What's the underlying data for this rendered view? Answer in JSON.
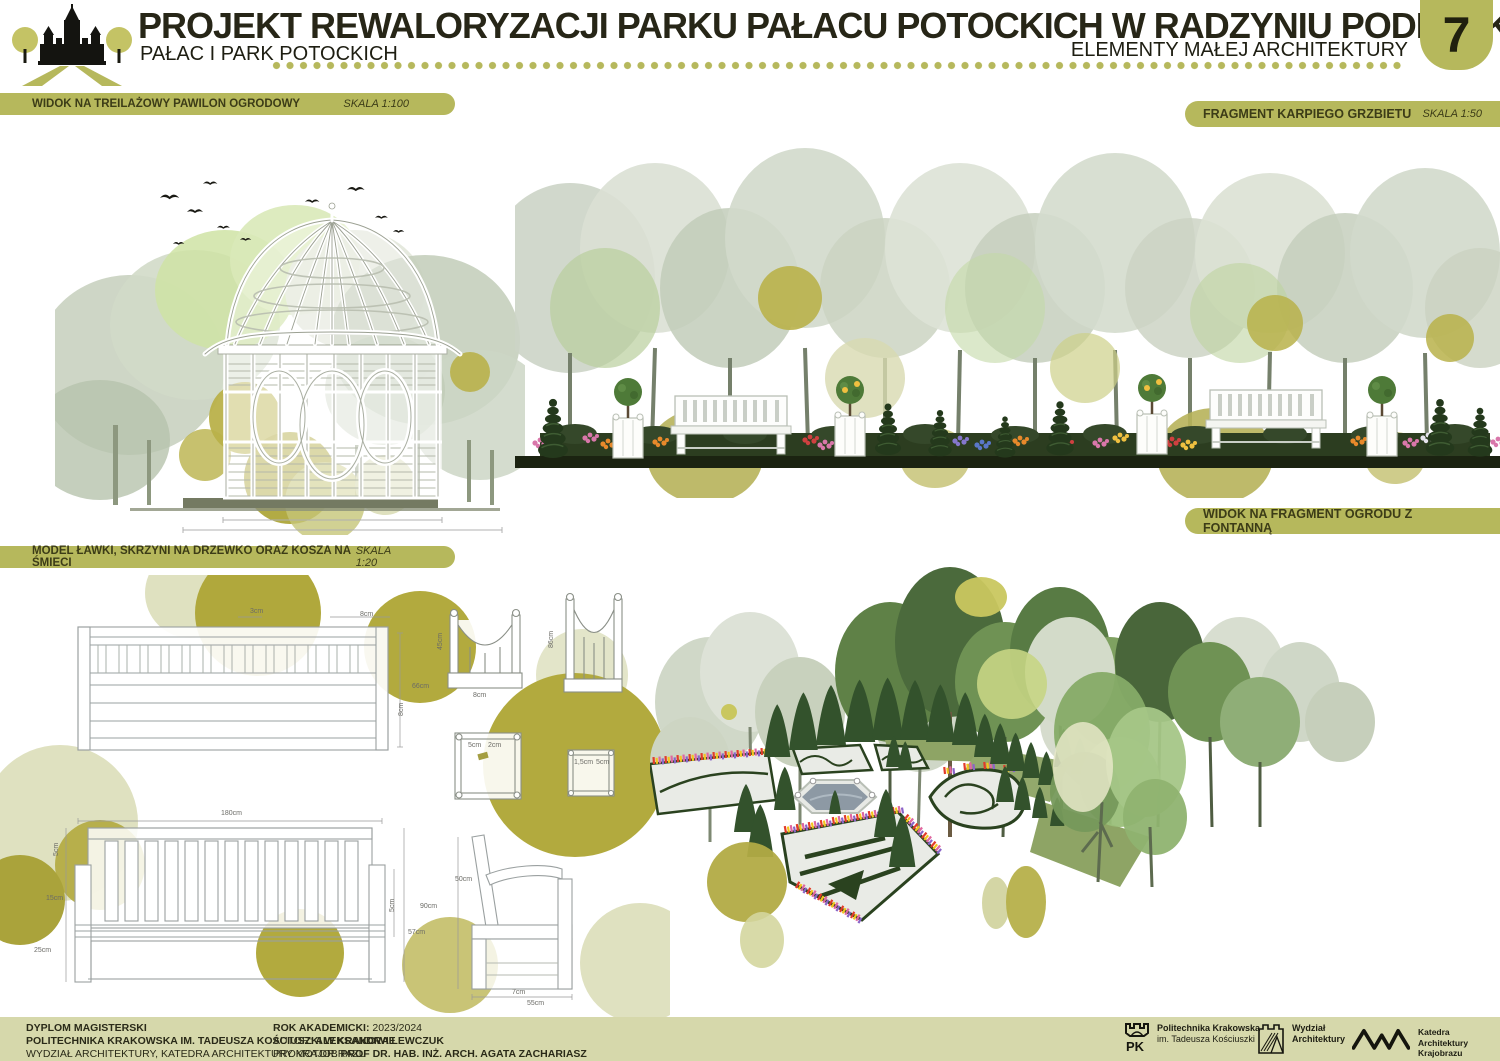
{
  "header": {
    "title": "PROJEKT REWALORYZACJI PARKU PAŁACU POTOCKICH W RADZYNIU PODLASKIM",
    "project_name": "PAŁAC I PARK POTOCKICH",
    "sheet_subject": "ELEMENTY MAŁEJ ARCHITEKTURY",
    "sheet_number": "7"
  },
  "section_labels": {
    "pavilion": {
      "title": "WIDOK NA TREILAŻOWY PAWILON OGRODOWY",
      "scale": "SKALA 1:100"
    },
    "carp_back": {
      "title": "FRAGMENT KARPIEGO GRZBIETU",
      "scale": "SKALA 1:50"
    },
    "fountain_view": {
      "title": "WIDOK NA FRAGMENT OGRODU Z FONTANNĄ"
    },
    "furniture": {
      "title": "MODEL ŁAWKI, SKRZYNI NA DRZEWKO ORAZ KOSZA NA ŚMIECI",
      "scale": "SKALA 1:20"
    }
  },
  "dimensions": {
    "bench_top": {
      "slat_gap": "3cm",
      "slat_w": "8cm",
      "depth": "66cm",
      "edge": "8cm"
    },
    "bench_front": {
      "width": "180cm",
      "h_top": "5cm",
      "h_mid": "15cm",
      "h_low": "25cm",
      "side_h": "5cm",
      "height": "90cm",
      "seat_h": "57cm"
    },
    "bench_side": {
      "back": "50cm",
      "leg": "7cm",
      "depth": "55cm"
    },
    "planter_small": {
      "height": "45cm",
      "base": "8cm"
    },
    "planter_large": {
      "height": "86cm"
    },
    "planter_plan_large": {
      "a": "5cm",
      "b": "2cm"
    },
    "planter_plan_small": {
      "a": "1,5cm",
      "b": "5cm"
    }
  },
  "footer": {
    "col1": {
      "line1": "DYPLOM MAGISTERSKI",
      "line2": "POLITECHNIKA KRAKOWSKA IM. TADEUSZA KOŚCIUSZKI W KRAKOWIE",
      "line3": "WYDZIAŁ ARCHITEKTURY, KATEDRA ARCHITEKTURY KRAJOBRAZU"
    },
    "col2": {
      "l1_label": "ROK AKADEMICKI:",
      "l1_value": "2023/2024",
      "l2_label": "AUTOR:",
      "l2_value": "ALEKSANDRA LEWCZUK",
      "l3_label": "PROMOTOR:",
      "l3_value": "PROF DR.  HAB. INŻ. ARCH. AGATA ZACHARIASZ"
    },
    "logos": {
      "pk": {
        "abbr": "PK",
        "line1": "Politechnika Krakowska",
        "line2": "im. Tadeusza Kościuszki"
      },
      "wa": {
        "line1": "Wydział",
        "line2": "Architektury"
      },
      "kak": {
        "line1": "Katedra",
        "line2": "Architektury",
        "line3": "Krajobrazu"
      }
    }
  },
  "colors": {
    "accent_olive": "#b6b85c",
    "footer_band": "#d6d8ab",
    "dark_text": "#2d2c18",
    "circle_dark_olive": "#b2aa3e",
    "circle_pale_olive": "#dfe1c0",
    "hedge_dark_green": "#2a3a20",
    "water_gray": "#8d99a4"
  }
}
